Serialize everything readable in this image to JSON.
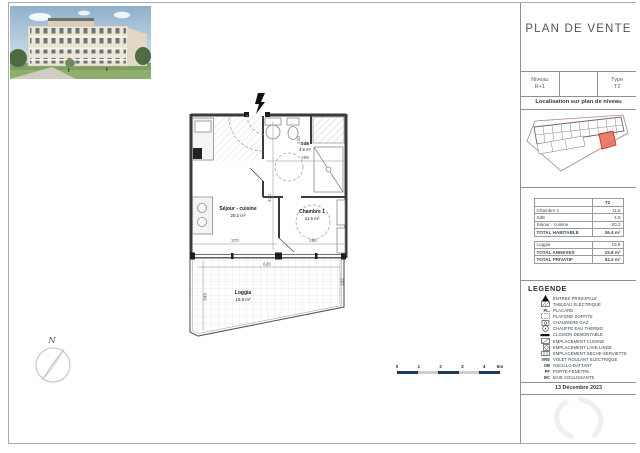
{
  "page": {
    "title": "PLAN DE VENTE",
    "date": "13 Décembre 2023"
  },
  "info_block": {
    "niveau_label": "Niveau",
    "niveau_value": "R+1",
    "type_label": "Type",
    "type_value": "T2"
  },
  "localisation": {
    "heading": "Localisation sur plan de niveau"
  },
  "surface_table": {
    "type_header": "T2",
    "rows": [
      {
        "label": "Chambre 1",
        "value": "11.5"
      },
      {
        "label": "SdE",
        "value": "4.8"
      },
      {
        "label": "Séjour - cuisine",
        "value": "20.2"
      }
    ],
    "total_habitable_label": "TOTAL HABITABLE",
    "total_habitable_value": "36.4 m²",
    "loggia_label": "Loggia",
    "loggia_value": "15.8",
    "total_annexes_label": "TOTAL ANNEXES",
    "total_annexes_value": "15.8 m²",
    "total_privatif_label": "TOTAL PRIVATIF",
    "total_privatif_value": "52.2 m²"
  },
  "legende": {
    "heading": "LEGENDE",
    "items": [
      {
        "icon": "entree-principale-icon",
        "label": "ENTREE PRINCIPALE"
      },
      {
        "icon": "tableau-electrique-icon",
        "label": "TABLEAU ELECTRIQUE"
      },
      {
        "abbrev": "PL.",
        "label": "PLACARD"
      },
      {
        "icon": "plafond-soffite-icon",
        "label": "PLAFOND SOFFITE"
      },
      {
        "icon": "chaudiere-gaz-icon",
        "label": "CHAUDIERE GAZ"
      },
      {
        "icon": "chauffe-eau-icon",
        "label": "CHAUFFE EAU THERMO"
      },
      {
        "icon": "cloison-icon",
        "label": "CLOISON DEMONTABLE"
      },
      {
        "icon": "emplacement-cuisine-icon",
        "label": "EMPLACEMENT CUISINE"
      },
      {
        "icon": "lave-linge-icon",
        "label": "EMPLACEMENT LAVE-LINGE"
      },
      {
        "icon": "seche-serviette-icon",
        "label": "EMPLACEMENT SECHE-SERVIETTE"
      },
      {
        "abbrev": "VRE",
        "label": "VOLET ROULANT ELECTRIQUE"
      },
      {
        "abbrev": "OB",
        "label": "OSCILLO-BATTANT"
      },
      {
        "abbrev": "PF",
        "label": "PORTE-FENETRE"
      },
      {
        "abbrev": "BC",
        "label": "BAIE COULISSANTE"
      }
    ]
  },
  "plan": {
    "rooms": [
      {
        "name": "Séjour - cuisine",
        "area": "20.2 m²"
      },
      {
        "name": "Chambre 1",
        "area": "11.5 m²"
      },
      {
        "name": "SdE",
        "area": "4.8 m²"
      },
      {
        "name": "Loggia",
        "area": "15.8 m²"
      }
    ],
    "dims": {
      "sejour_w": "370",
      "chambre_w": "290",
      "sejour_h": "470",
      "sde_w": "299",
      "sde_h": "210",
      "loggia_w": "626",
      "loggia_h": "343",
      "loggia_r": "192"
    }
  },
  "compass": {
    "north": "N"
  },
  "scalebar": {
    "ticks": [
      "0",
      "1",
      "2",
      "3",
      "4",
      "5m"
    ]
  },
  "colors": {
    "accent_red": "#d9534f",
    "scale_navy": "#1c3a5e",
    "scale_gray": "#c9ced4"
  }
}
